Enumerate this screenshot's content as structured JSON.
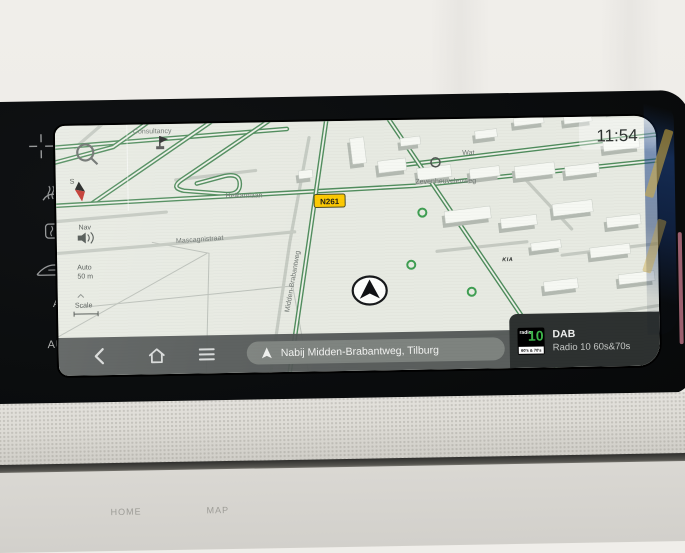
{
  "screen": {
    "clock": "11:54",
    "map": {
      "road_shield": "N261",
      "streets": {
        "consultancy": "Consultancy",
        "helkantlaan": "Helkantlaan",
        "mascagnistraat": "Mascagnistraat",
        "midden_brabantweg": "Midden-Brabantweg",
        "zevenheuvelenweg": "Zevenheuvelenweg",
        "wat": "Wat"
      },
      "poi_kia": "KIA",
      "compass_south": "S",
      "nav_volume_label": "Nav",
      "zoom_mode": "Auto",
      "zoom_scale": "50 m",
      "scale_label": "Scale"
    },
    "bottom_bar": {
      "nav_status": "Nabij Midden-Brabantweg, Tilburg"
    },
    "media": {
      "source": "DAB",
      "station": "Radio 10 60s&70s",
      "logo_word": "radio",
      "logo_number": "10",
      "logo_strip": "60's & 70's HITS"
    }
  },
  "climate_panel": {
    "ac_label": "A/C",
    "auto_label": "AUTO"
  },
  "dash_labels": {
    "home": "HOME",
    "map": "MAP"
  },
  "colors": {
    "radio_green": "#3db54a",
    "shield_yellow": "#fcc800",
    "road_green": "#4f8c5c",
    "map_bg": "#e7eae2"
  }
}
